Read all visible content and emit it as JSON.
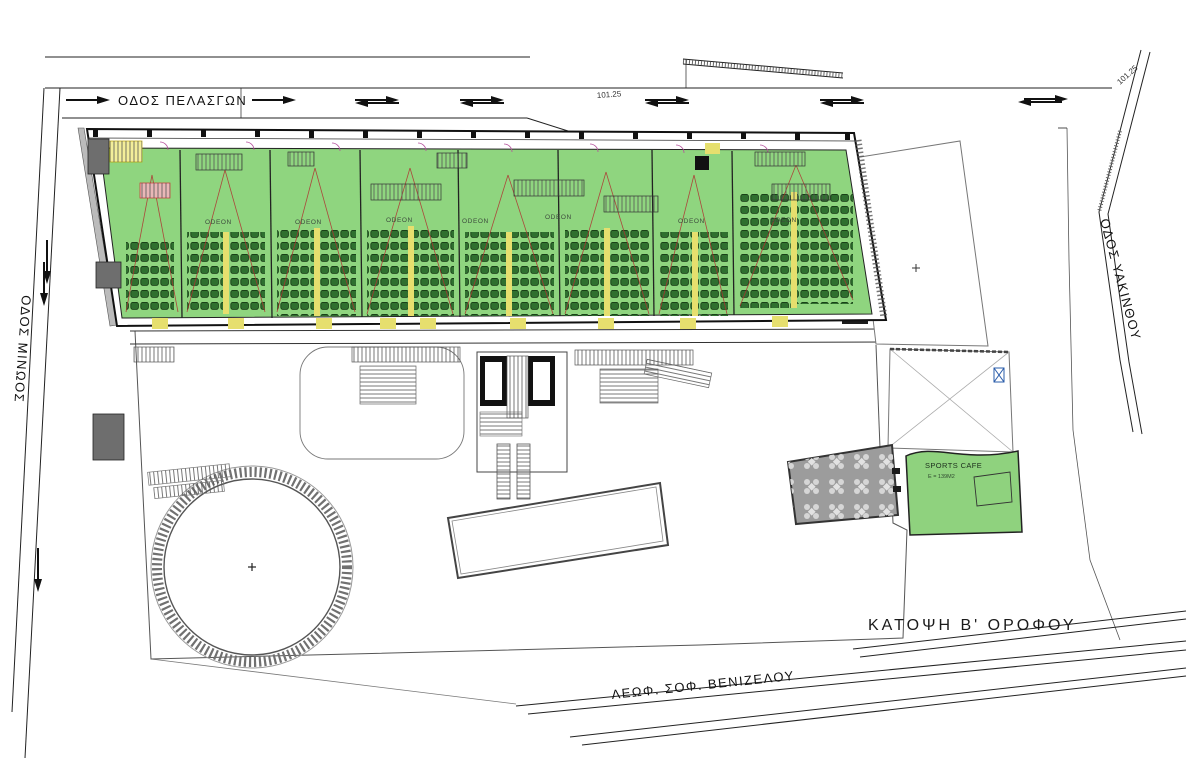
{
  "drawing": {
    "caption": "ΚΑΤΟΨΗ Β' ΟΡΟΦΟΥ",
    "streets": {
      "top": "ΟΔΟΣ ΠΕΛΑΣΓΩΝ",
      "left": "ΟΔΟΣ ΜΙΝΩΟΣ",
      "right": "ΟΔΟΣ ΥΑΚΙΝΘΟΥ",
      "bottom": "ΛΕΩΦ. ΣΟΦ. ΒΕΝΙΖΕΛΟΥ"
    },
    "dimensions": {
      "top_center": "101.25",
      "top_right": "101.25"
    },
    "halls": [
      {
        "label": "ODEON"
      },
      {
        "label": "ODEON"
      },
      {
        "label": "ODEON"
      },
      {
        "label": "ODEON"
      },
      {
        "label": "ODEON"
      },
      {
        "label": "ODEON"
      },
      {
        "label": "ODEON"
      }
    ],
    "cafe": {
      "name": "SPORTS CAFE",
      "area": "E = 139M2"
    },
    "colors": {
      "floor_green": "#8FD57F",
      "seat_green": "#2F6F2F",
      "aisle_yellow": "#E6DF6E",
      "sightline_red": "#B03030",
      "terrace_gray": "#9C9C9C",
      "cafe_green": "#8FD27E"
    }
  }
}
